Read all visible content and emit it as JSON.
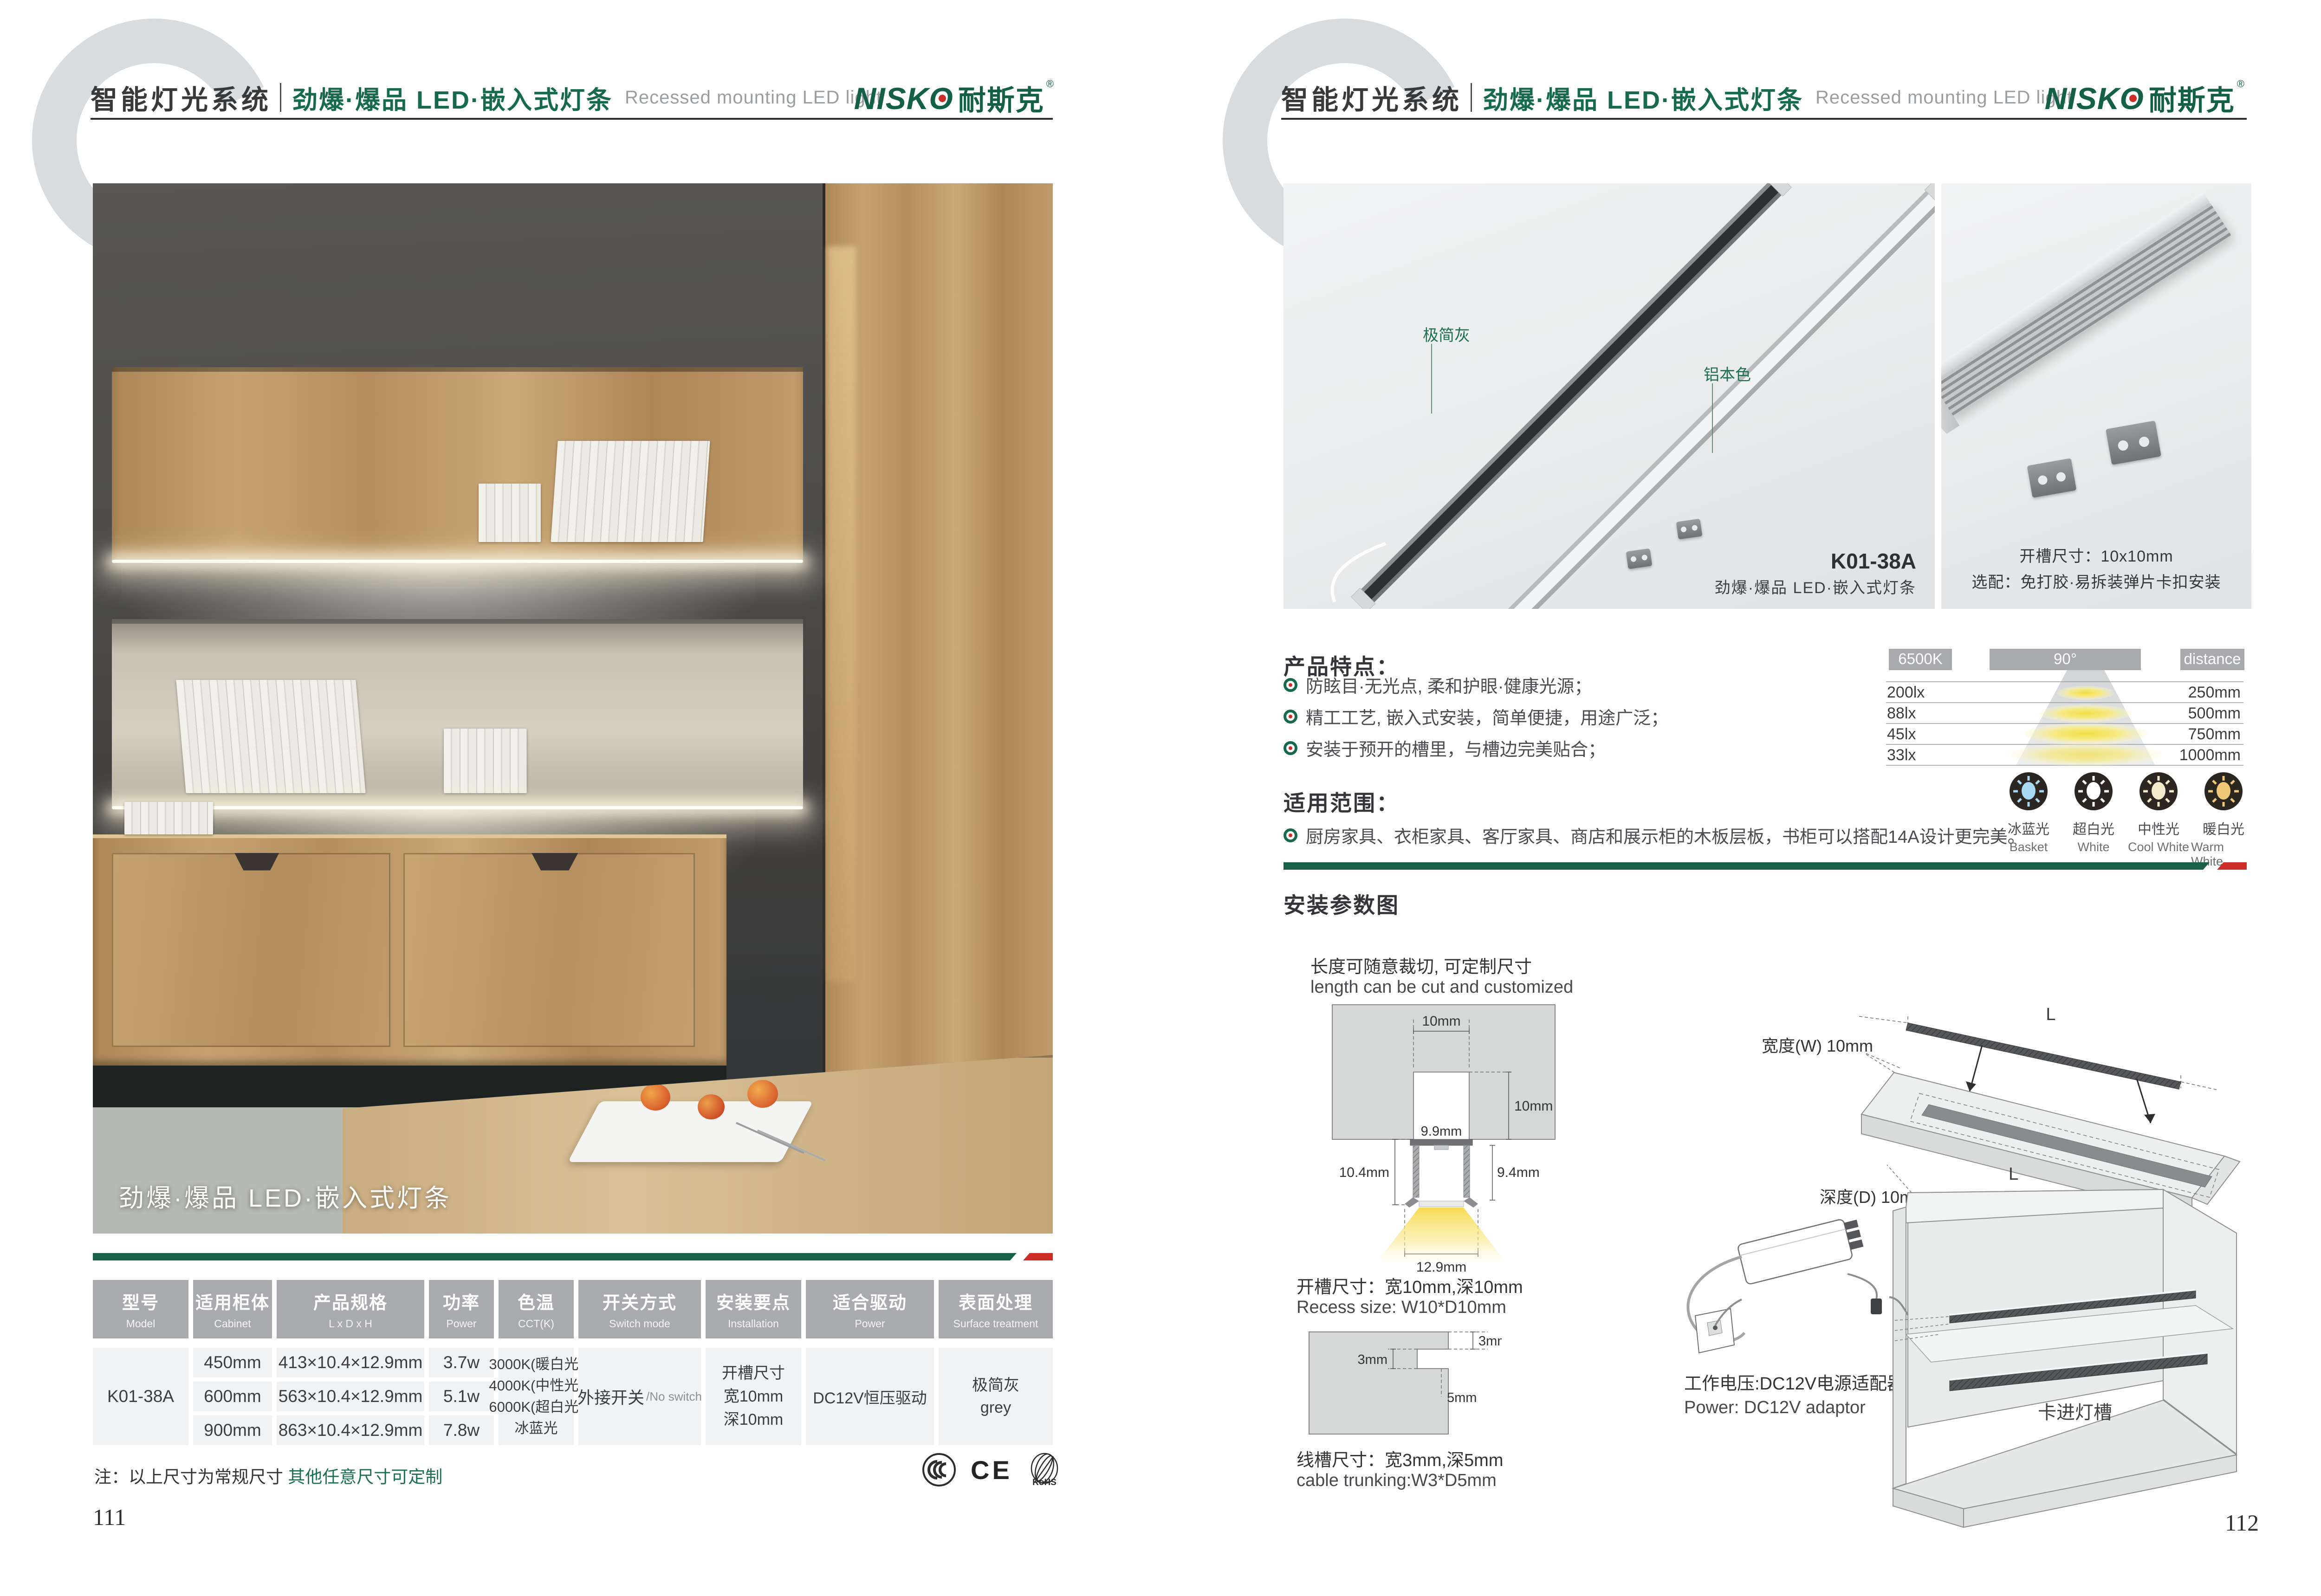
{
  "colors": {
    "brand_green": "#176a4e",
    "accent_red": "#cc2d26",
    "table_header_gray": "#a8aaad",
    "cell_gray": "#f1f2f4",
    "watermark_gray": "#d9dcde"
  },
  "header": {
    "watermark": "C",
    "system_cn": "智能灯光系统",
    "subtitle_cn": "劲爆·爆品  LED·嵌入式灯条",
    "subtitle_en": "Recessed mounting LED light",
    "brand_latin": "NISKO",
    "brand_cn": "耐斯克",
    "brand_reg": "®"
  },
  "left_page": {
    "photo_caption": "劲爆·爆品  LED·嵌入式灯条",
    "table": {
      "headers": [
        {
          "cn": "型号",
          "en": "Model"
        },
        {
          "cn": "适用柜体",
          "en": "Cabinet"
        },
        {
          "cn": "产品规格",
          "en": "L x D x H"
        },
        {
          "cn": "功率",
          "en": "Power"
        },
        {
          "cn": "色温",
          "en": "CCT(K)"
        },
        {
          "cn": "开关方式",
          "en": "Switch mode"
        },
        {
          "cn": "安装要点",
          "en": "Installation"
        },
        {
          "cn": "适合驱动",
          "en": "Power"
        },
        {
          "cn": "表面处理",
          "en": "Surface treatment"
        }
      ],
      "model": "K01-38A",
      "rows": [
        {
          "cabinet": "450mm",
          "spec": "413×10.4×12.9mm",
          "power": "3.7w"
        },
        {
          "cabinet": "600mm",
          "spec": "563×10.4×12.9mm",
          "power": "5.1w"
        },
        {
          "cabinet": "900mm",
          "spec": "863×10.4×12.9mm",
          "power": "7.8w"
        }
      ],
      "cct_lines": [
        "3000K(暖白光)",
        "4000K(中性光)",
        "6000K(超白光)",
        "冰蓝光"
      ],
      "switch_cn": "外接开关",
      "switch_en": "/No switch",
      "install_lines": [
        "开槽尺寸",
        "宽10mm",
        "深10mm"
      ],
      "driver": "DC12V恒压驱动",
      "surface_cn": "极简灰",
      "surface_en": "grey"
    },
    "note_dark": "注：以上尺寸为常规尺寸",
    "note_green": "其他任意尺寸可定制",
    "certs": {
      "ccc": "CCC",
      "ce": "CE",
      "rohs": "RoHS"
    },
    "page_number": "111"
  },
  "right_page": {
    "photo_main": {
      "label_gray": "极简灰",
      "label_alu": "铝本色",
      "model": "K01-38A",
      "caption": "劲爆·爆品  LED·嵌入式灯条"
    },
    "photo_side": {
      "line1": "开槽尺寸：10x10mm",
      "line2": "选配：免打胶·易拆装弹片卡扣安装"
    },
    "features": {
      "title": "产品特点：",
      "items": [
        "防眩目·无光点, 柔和护眼·健康光源；",
        "精工工艺, 嵌入式安装，简单便捷，用途广泛；",
        "安装于预开的槽里，与槽边完美贴合；"
      ]
    },
    "scope": {
      "title": "适用范围：",
      "items": [
        "厨房家具、衣柜家具、客厅家具、商店和展示柜的木板层板，书柜可以搭配14A设计更完美。"
      ]
    },
    "light_chart": {
      "type": "table",
      "badges": [
        "6500K",
        "90°",
        "distance"
      ],
      "rows": [
        {
          "lux": "200lx",
          "distance": "250mm"
        },
        {
          "lux": "88lx",
          "distance": "500mm"
        },
        {
          "lux": "45lx",
          "distance": "750mm"
        },
        {
          "lux": "33lx",
          "distance": "1000mm"
        }
      ]
    },
    "color_modes": [
      {
        "cn": "冰蓝光",
        "en": "Basket",
        "color": "#a9d9f2"
      },
      {
        "cn": "超白光",
        "en": "White",
        "color": "#ffffff"
      },
      {
        "cn": "中性光",
        "en": "Cool White",
        "color": "#f3e9cb"
      },
      {
        "cn": "暖白光",
        "en": "Warm White",
        "color": "#efc878"
      }
    ],
    "install": {
      "title": "安装参数图",
      "cut_cn": "长度可随意裁切, 可定制尺寸",
      "cut_en": "length can be cut and customized",
      "cross": {
        "top_w": "10mm",
        "slot_d": "10mm",
        "inner_w": "9.9mm",
        "left_h": "10.4mm",
        "right_h": "9.4mm",
        "bottom_w": "12.9mm"
      },
      "recess_cn": "开槽尺寸：宽10mm,深10mm",
      "recess_en": "Recess size: W10*D10mm",
      "trunk": {
        "edge": "3mm",
        "width": "3mm",
        "depth": "5mm"
      },
      "trunk_cn": "线槽尺寸：宽3mm,深5mm",
      "trunk_en": "cable trunking:W3*D5mm",
      "panel": {
        "len_top": "L",
        "len_inner": "L",
        "width": "宽度(W) 10mm",
        "depth": "深度(D) 10mm",
        "caption": "建议开槽尺寸"
      },
      "power_cn": "工作电压:DC12V电源适配器",
      "power_en": "Power: DC12V adaptor",
      "snap_label": "卡进灯槽"
    },
    "page_number": "112"
  }
}
